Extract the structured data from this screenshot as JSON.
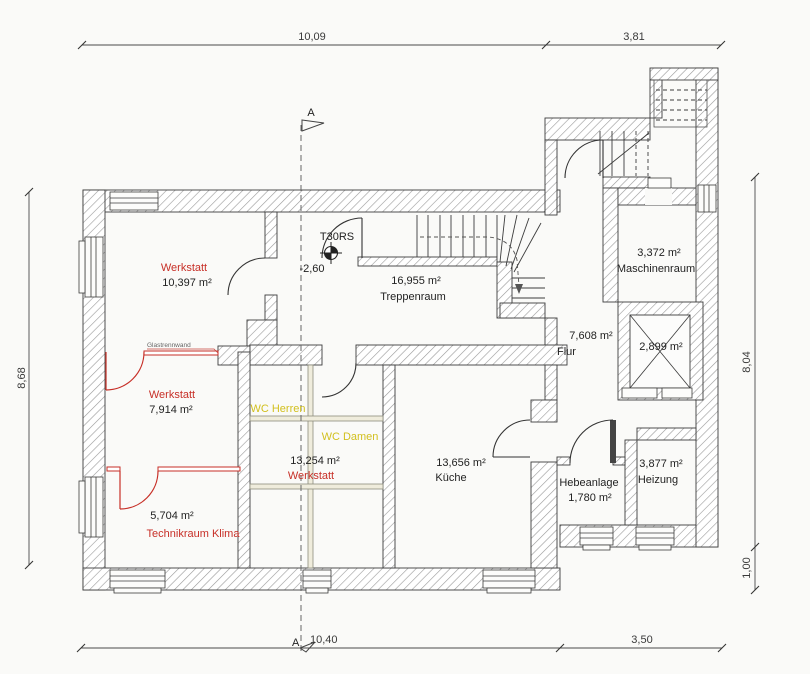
{
  "document": {
    "type": "basement floor plan (scan)"
  },
  "colors": {
    "red": "#c72f27",
    "yellow": "#d2c01f",
    "ink": "#222222",
    "hatch": "#9a9a9a",
    "paper": "#fafaf8"
  },
  "dimensions": {
    "top_left": "10,09",
    "top_right": "3,81",
    "left": "8,68",
    "right_upper": "8,04",
    "right_lower": "1,00",
    "bottom_left": "10,40",
    "bottom_right": "3,50"
  },
  "section": {
    "label_top": "A",
    "label_bottom": "A"
  },
  "fire_door": {
    "label": "T30RS",
    "level": "-2,60"
  },
  "rooms": {
    "werkstatt1": {
      "name": "Werkstatt",
      "area": "10,397 m²"
    },
    "treppenraum": {
      "name": "Treppenraum",
      "area": "16,955 m²"
    },
    "maschinenraum": {
      "name": "Maschinenraum",
      "area": "3,372 m²"
    },
    "flur": {
      "name": "Flur",
      "area": "7,608 m²"
    },
    "aufzug": {
      "area": "2,899 m²"
    },
    "werkstatt2": {
      "name": "Werkstatt",
      "area": "7,914 m²"
    },
    "wc_herren": {
      "name": "WC Herren"
    },
    "wc_damen": {
      "name": "WC Damen"
    },
    "werkstatt3": {
      "name": "Werkstatt",
      "area": "13,254 m²"
    },
    "kueche": {
      "name": "Küche",
      "area": "13,656 m²"
    },
    "hebeanlage": {
      "name": "Hebeanlage",
      "area": "1,780 m²"
    },
    "heizung": {
      "name": "Heizung",
      "area": "3,877 m²"
    },
    "technikraum": {
      "name": "Technikraum Klima",
      "area": "5,704 m²"
    }
  },
  "annotations": {
    "glass_wall": "Glastrennwand"
  }
}
